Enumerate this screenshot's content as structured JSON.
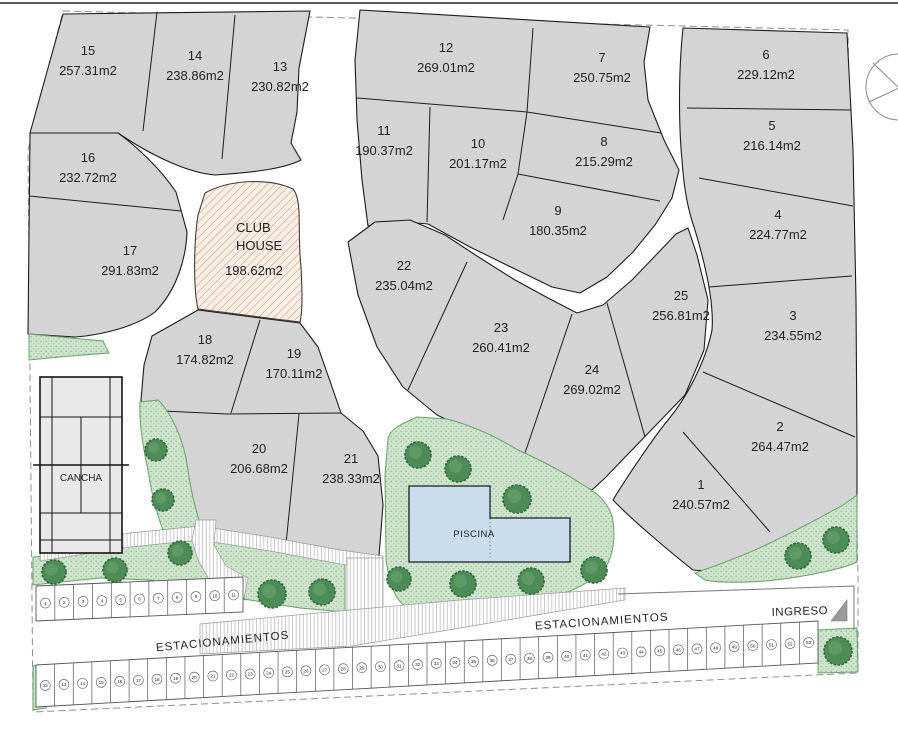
{
  "plan": {
    "lots": [
      {
        "num": "1",
        "area": "240.57m2"
      },
      {
        "num": "2",
        "area": "264.47m2"
      },
      {
        "num": "3",
        "area": "234.55m2"
      },
      {
        "num": "4",
        "area": "224.77m2"
      },
      {
        "num": "5",
        "area": "216.14m2"
      },
      {
        "num": "6",
        "area": "229.12m2"
      },
      {
        "num": "7",
        "area": "250.75m2"
      },
      {
        "num": "8",
        "area": "215.29m2"
      },
      {
        "num": "9",
        "area": "180.35m2"
      },
      {
        "num": "10",
        "area": "201.17m2"
      },
      {
        "num": "11",
        "area": "190.37m2"
      },
      {
        "num": "12",
        "area": "269.01m2"
      },
      {
        "num": "13",
        "area": "230.82m2"
      },
      {
        "num": "14",
        "area": "238.86m2"
      },
      {
        "num": "15",
        "area": "257.31m2"
      },
      {
        "num": "16",
        "area": "232.72m2"
      },
      {
        "num": "17",
        "area": "291.83m2"
      },
      {
        "num": "18",
        "area": "174.82m2"
      },
      {
        "num": "19",
        "area": "170.11m2"
      },
      {
        "num": "20",
        "area": "206.68m2"
      },
      {
        "num": "21",
        "area": "238.33m2"
      },
      {
        "num": "22",
        "area": "235.04m2"
      },
      {
        "num": "23",
        "area": "260.41m2"
      },
      {
        "num": "24",
        "area": "269.02m2"
      },
      {
        "num": "25",
        "area": "256.81m2"
      }
    ],
    "club_house": {
      "line1": "CLUB",
      "line2": "HOUSE",
      "area": "198.62m2"
    },
    "cancha_label": "CANCHA",
    "piscina_label": "PISCINA",
    "parking_label_left": "ESTACIONAMIENTOS",
    "parking_label_right": "ESTACIONAMIENTOS",
    "entrance_label": "INGRESO",
    "parking_spaces_top": [
      "1",
      "2",
      "3",
      "4",
      "5",
      "6",
      "7",
      "8",
      "9",
      "10",
      "11"
    ],
    "parking_spaces_bottom": [
      "12",
      "13",
      "14",
      "15",
      "16",
      "17",
      "18",
      "19",
      "20",
      "21",
      "22",
      "23",
      "24",
      "25",
      "26",
      "27",
      "28",
      "29",
      "30",
      "31",
      "32",
      "33",
      "34",
      "35",
      "36",
      "37",
      "38",
      "39",
      "40",
      "41",
      "42",
      "43",
      "44",
      "45",
      "46",
      "47",
      "48",
      "49",
      "50",
      "51",
      "52",
      "53"
    ],
    "colors": {
      "lot_fill": "#d4d4d4",
      "lot_stroke": "#1c1c1c",
      "road": "#ffffff",
      "green_fill": "#cfe4cc",
      "green_edge": "#69a06f",
      "tree_fill": "#4e8c57",
      "tree_edge": "#31663c",
      "pool_fill": "#c9dded",
      "clubhouse_fill": "#f9efe7",
      "clubhouse_hatch": "#c98f73"
    }
  }
}
